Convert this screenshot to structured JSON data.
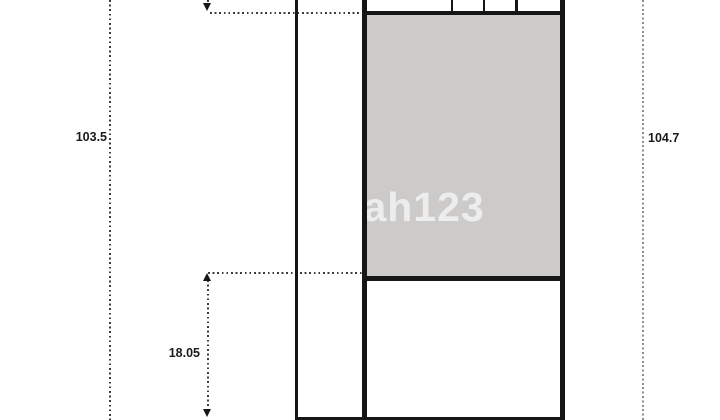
{
  "plan": {
    "watermark": "rumah123",
    "labels": {
      "left_boundary_length": "103.5",
      "right_boundary_length": "104.7",
      "lower_segment_length": "18.05"
    },
    "colors": {
      "background": "#ffffff",
      "room_fill": "#cdcbc9",
      "wall": "#161616",
      "dotted_dark": "#3c3c3c",
      "dotted_light": "#8d8d8d",
      "label_text": "#1b1b1b",
      "watermark": "rgba(255,255,255,0.66)"
    }
  }
}
